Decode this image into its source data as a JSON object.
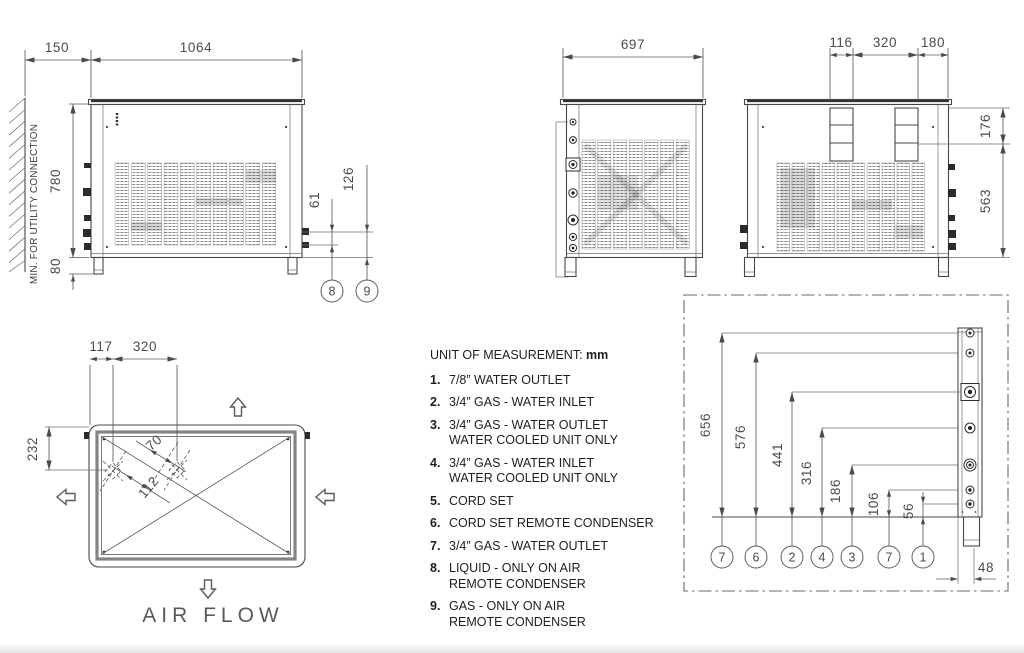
{
  "drawing": {
    "front_view": {
      "wall_note": "MIN. FOR UTILITY CONNECTION",
      "dim_wall_clearance": "150",
      "dim_width": "1064",
      "dim_height": "780",
      "dim_leg_height": "80",
      "dim_liquid_offset": "61",
      "dim_gas_offset": "126",
      "callout_liquid": "8",
      "callout_gas": "9"
    },
    "side_view": {
      "dim_depth": "697"
    },
    "rear_view": {
      "dim_box_width": "116",
      "dim_box_spacing": "320",
      "dim_box_edge": "180",
      "dim_upper_height": "176",
      "dim_lower_height": "563"
    },
    "top_view": {
      "dim_fan_offset_x": "117",
      "dim_fan_spacing": "320",
      "dim_fan_offset_y": "232",
      "dim_diag_small": "70",
      "dim_diag_large": "112",
      "air_flow_label": "AIR FLOW"
    },
    "detail_view": {
      "dim_656": "656",
      "dim_576": "576",
      "dim_441": "441",
      "dim_316": "316",
      "dim_186": "186",
      "dim_106": "106",
      "dim_56": "56",
      "dim_48": "48",
      "callouts": [
        "7",
        "6",
        "2",
        "4",
        "3",
        "7",
        "1"
      ]
    }
  },
  "legend": {
    "header_label": "UNIT OF MEASUREMENT:",
    "header_unit": "mm",
    "items": [
      {
        "num": "1.",
        "line1": "7/8” WATER OUTLET",
        "line2": ""
      },
      {
        "num": "2.",
        "line1": "3/4” GAS - WATER INLET",
        "line2": ""
      },
      {
        "num": "3.",
        "line1": "3/4” GAS - WATER OUTLET",
        "line2": "WATER COOLED UNIT ONLY"
      },
      {
        "num": "4.",
        "line1": "3/4” GAS - WATER INLET",
        "line2": "WATER COOLED UNIT ONLY"
      },
      {
        "num": "5.",
        "line1": "CORD SET",
        "line2": ""
      },
      {
        "num": "6.",
        "line1": "CORD SET REMOTE CONDENSER",
        "line2": ""
      },
      {
        "num": "7.",
        "line1": "3/4” GAS - WATER OUTLET",
        "line2": ""
      },
      {
        "num": "8.",
        "line1": "LIQUID - ONLY ON AIR",
        "line2": "REMOTE CONDENSER"
      },
      {
        "num": "9.",
        "line1": "GAS - ONLY ON AIR",
        "line2": "REMOTE CONDENSER"
      }
    ]
  },
  "colors": {
    "line": "#474747",
    "dim": "#5d5d5d",
    "text": "#1e1e1e",
    "dim_text": "#4b4b4b"
  }
}
